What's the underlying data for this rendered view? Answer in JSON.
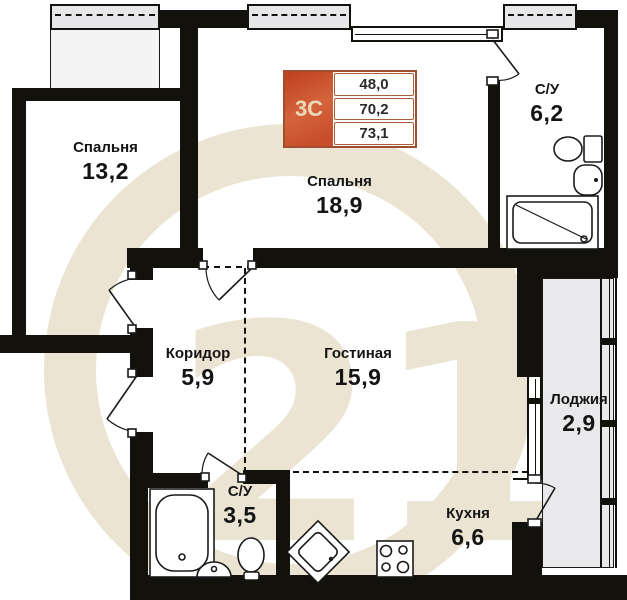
{
  "plan": {
    "watermark_text": "21",
    "info_box": {
      "type": "3С",
      "values": [
        "48,0",
        "70,2",
        "73,1"
      ]
    },
    "rooms": [
      {
        "name": "Спальня",
        "area": "13,2"
      },
      {
        "name": "Спальня",
        "area": "18,9"
      },
      {
        "name": "С/У",
        "area": "6,2"
      },
      {
        "name": "Коридор",
        "area": "5,9"
      },
      {
        "name": "Гостиная",
        "area": "15,9"
      },
      {
        "name": "Лоджия",
        "area": "2,9"
      },
      {
        "name": "С/У",
        "area": "3,5"
      },
      {
        "name": "Кухня",
        "area": "6,6"
      }
    ],
    "colors": {
      "wall": "#13110c",
      "accent": "#c84d2a",
      "watermark": "#ece4d2",
      "window_fill": "#e9e9eb"
    }
  }
}
